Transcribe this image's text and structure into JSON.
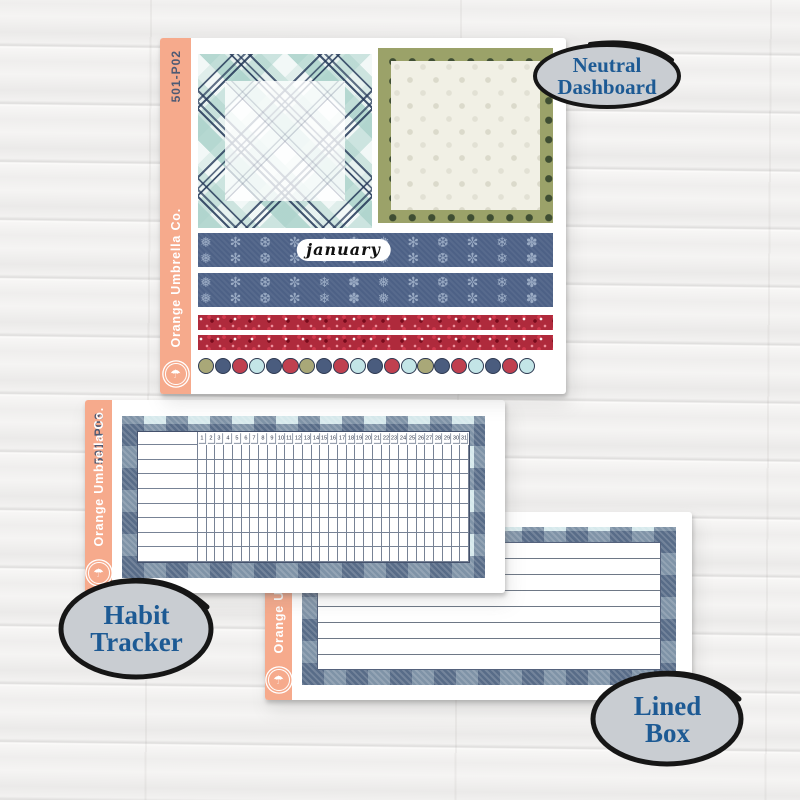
{
  "labels": {
    "neutral_dashboard": {
      "line1": "Neutral",
      "line2": "Dashboard"
    },
    "habit_tracker": {
      "line1": "Habit",
      "line2": "Tracker"
    },
    "lined_box": {
      "line1": "Lined",
      "line2": "Box"
    }
  },
  "palette": {
    "orange_bar": "#F6AA8C",
    "navy": "#4A5C7E",
    "red": "#C0404F",
    "olive": "#A9A878",
    "light_blue": "#C3E5E7",
    "oval_fill": "#C9CDD2",
    "oval_text": "#1D5A94",
    "washi_navy": "#4D6186",
    "glitter_red": "#AF2A3C",
    "polka_border_olive": "#9BA269"
  },
  "sheets": {
    "dashboard": {
      "code": "501-P02",
      "brand": "Orange Umbrella Co.",
      "month_label": "january",
      "dot_colors": [
        "olive",
        "navy",
        "red",
        "light_blue",
        "navy",
        "red",
        "olive",
        "navy",
        "red",
        "light_blue",
        "navy",
        "red",
        "light_blue",
        "olive",
        "navy",
        "red",
        "light_blue",
        "navy",
        "red",
        "light_blue"
      ]
    },
    "habit": {
      "code": "501-P03",
      "brand": "Orange Umbrella Co.",
      "day_numbers": [
        1,
        2,
        3,
        4,
        5,
        6,
        7,
        8,
        9,
        10,
        11,
        12,
        13,
        14,
        15,
        16,
        17,
        18,
        19,
        20,
        21,
        22,
        23,
        24,
        25,
        26,
        27,
        28,
        29,
        30,
        31
      ],
      "habit_rows": 8
    },
    "lined": {
      "brand": "Orange Umbrella Co.",
      "line_count": 8
    }
  }
}
